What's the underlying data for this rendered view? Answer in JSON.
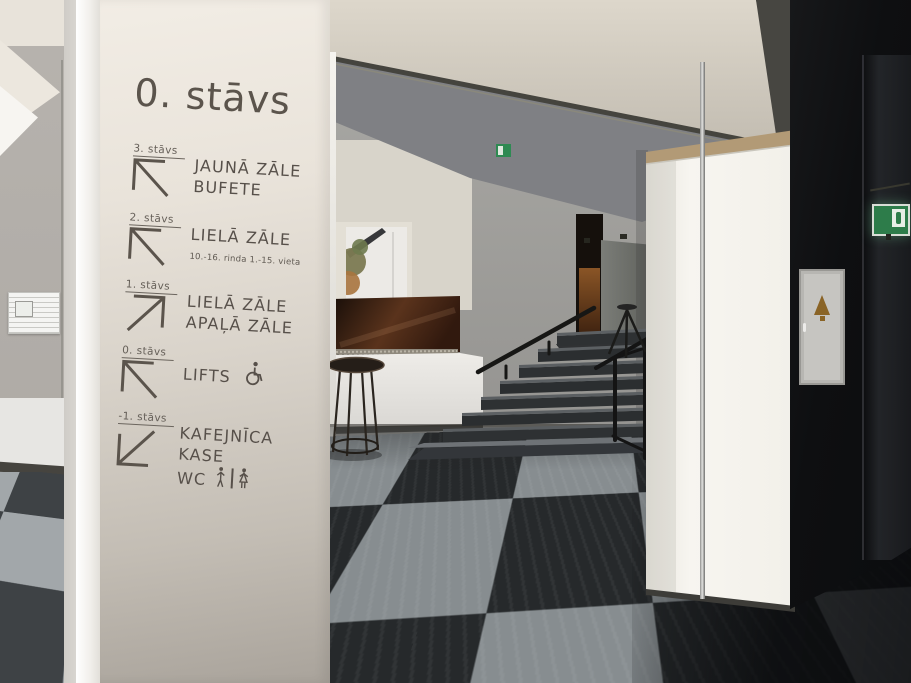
{
  "sign": {
    "title": "0. stāvs",
    "text_color": "#57504a",
    "entries": [
      {
        "floor": "3. stāvs",
        "direction": "up-left",
        "lines": [
          "JAUNĀ ZĀLE",
          "BUFETE"
        ]
      },
      {
        "floor": "2. stāvs",
        "direction": "up-left",
        "lines": [
          "LIELĀ ZĀLE"
        ],
        "note": "10.-16. rinda 1.-15. vieta"
      },
      {
        "floor": "1. stāvs",
        "direction": "up-right",
        "lines": [
          "LIELĀ ZĀLE",
          "APAĻĀ ZĀLE"
        ]
      },
      {
        "floor": "0. stāvs",
        "direction": "up-left",
        "lines": [
          "LIFTS"
        ],
        "icons": [
          "wheelchair-icon"
        ]
      },
      {
        "floor": "-1. stāvs",
        "direction": "down-left",
        "lines": [
          "KAFEJNĪCA",
          "KASE",
          "WC"
        ],
        "icons": [
          "wc-men-icon",
          "wc-women-icon"
        ]
      }
    ]
  },
  "scene": {
    "fixtures": [
      "wayfinding-pillar",
      "checkerboard-floor",
      "staircase",
      "handrail",
      "stair-railing",
      "tripod-stand",
      "bar-table",
      "reception-counter",
      "brown-glass-panel",
      "window-view",
      "sliding-door-track",
      "white-wall-panel",
      "black-wall",
      "fire-hose-cabinet",
      "exit-sign",
      "exit-sign-far",
      "evacuation-plan-poster"
    ],
    "palette": {
      "pillar_top": "#f2ede5",
      "pillar_bottom": "#a9a39b",
      "sign_text": "#57504a",
      "floor_dark": "#26292b",
      "floor_light": "#878d90",
      "black_wall": "#0e0f11",
      "exit_green": "#2d7c4a",
      "beam_cream": "#ddd7cb",
      "brown_glass": "#5a331c",
      "panel_white": "#f6f4ef",
      "cabinet_gold": "#8a6426"
    }
  }
}
